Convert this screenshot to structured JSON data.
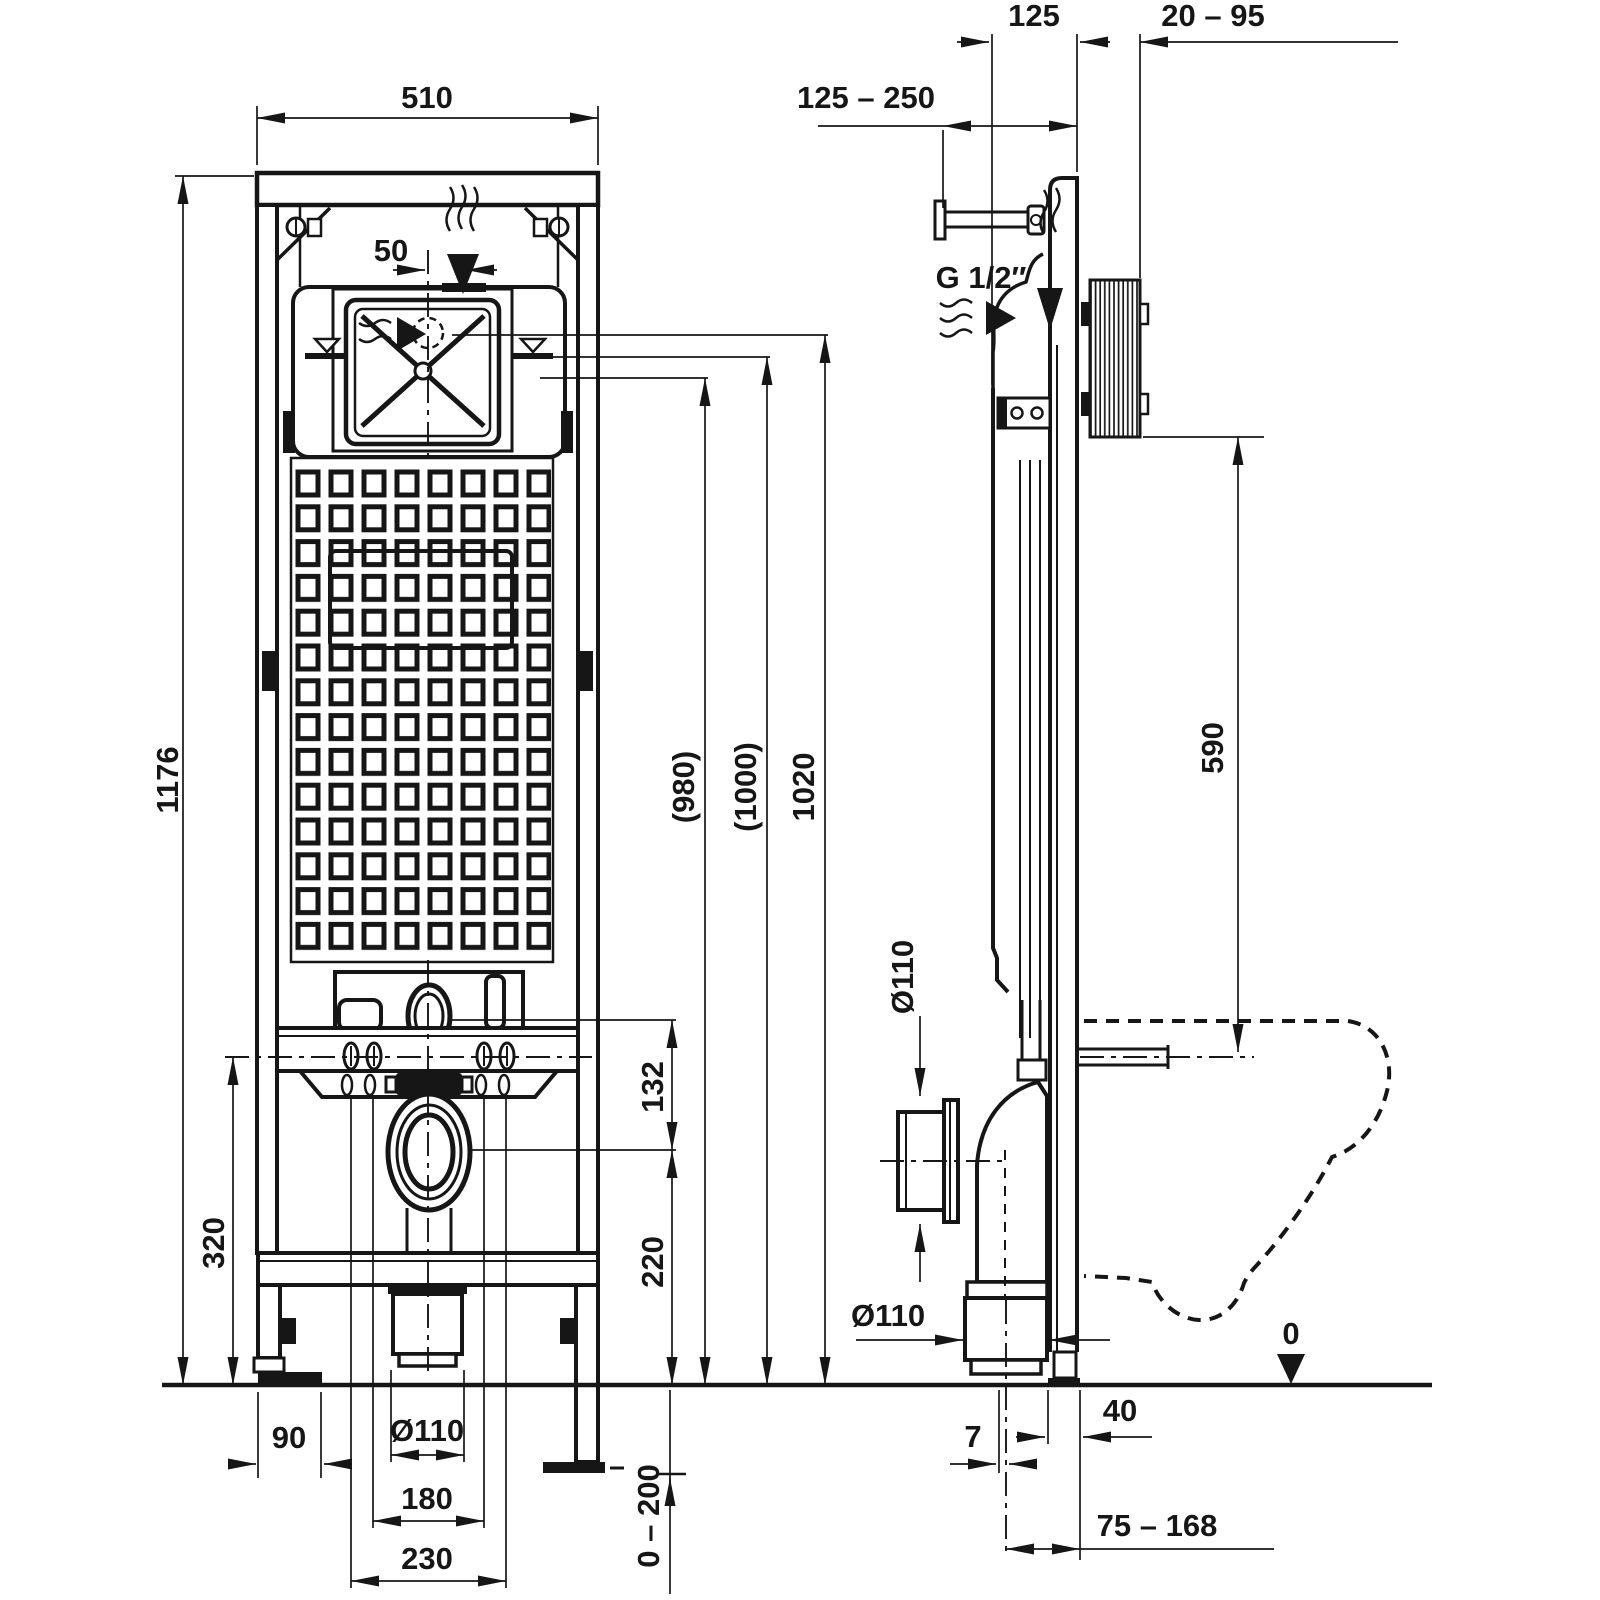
{
  "front_view": {
    "width": "510",
    "height": "1176",
    "inlet_offset": "50",
    "height_980": "(980)",
    "height_1000": "(1000)",
    "height_1020": "1020",
    "flush_to_outlet": "132",
    "outlet_height": "220",
    "fixing_height": "320",
    "foot_offset": "90",
    "drain_diameter": "Ø110",
    "bolt_spacing_inner": "180",
    "bolt_spacing_outer": "230",
    "leg_adjust_range": "0 – 200"
  },
  "side_view": {
    "frame_depth": "125",
    "wall_thickness_range": "20 – 95",
    "bracket_range": "125 – 250",
    "water_connection": "G 1/2″",
    "bowl_height": "590",
    "outlet_stub_diameter": "Ø110",
    "drain_pipe_diameter": "Ø110",
    "center_offset": "7",
    "rail_offset": "40",
    "drain_position_range": "75 – 168",
    "floor_datum": "0"
  }
}
